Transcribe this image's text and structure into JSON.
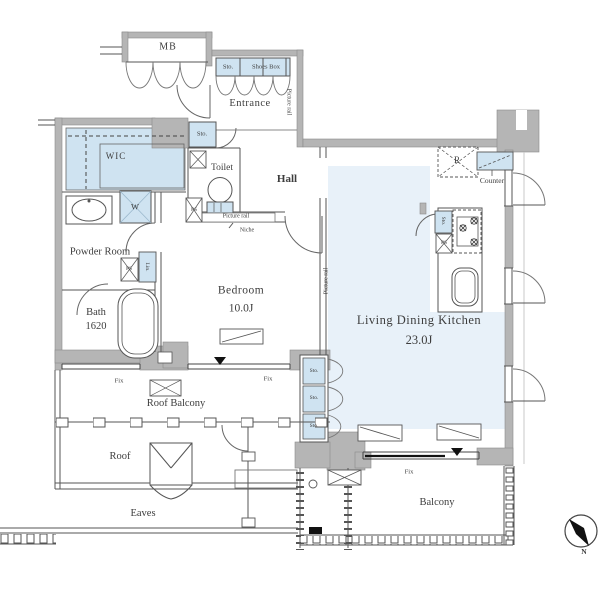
{
  "plan": {
    "rooms": {
      "mb": "MB",
      "entrance": "Entrance",
      "wic": "WIC",
      "toilet": "Toilet",
      "hall": "Hall",
      "powder_room": "Powder Room",
      "bath": "Bath",
      "bath_size": "1620",
      "bedroom": "Bedroom",
      "bedroom_size": "10.0J",
      "ldk": "Living Dining Kitchen",
      "ldk_size": "23.0J",
      "roof_balcony": "Roof Balcony",
      "roof": "Roof",
      "eaves": "Eaves",
      "balcony": "Balcony"
    },
    "labels": {
      "storage": "Sto.",
      "shoes_box": "Shoes Box",
      "washing_machine": "W",
      "pipe_space": "PS",
      "linen": "Lin.",
      "refrigerator": "R",
      "counter": "Counter",
      "picture_rail": "Picture rail",
      "niche": "Niche",
      "fixed_window": "Fix",
      "north": "N"
    },
    "colors": {
      "fixture_blue": "#cfe3f1",
      "floor_blue": "#e8f1f9",
      "wall_gray": "#b5b5b5",
      "line_gray": "#555555"
    }
  }
}
